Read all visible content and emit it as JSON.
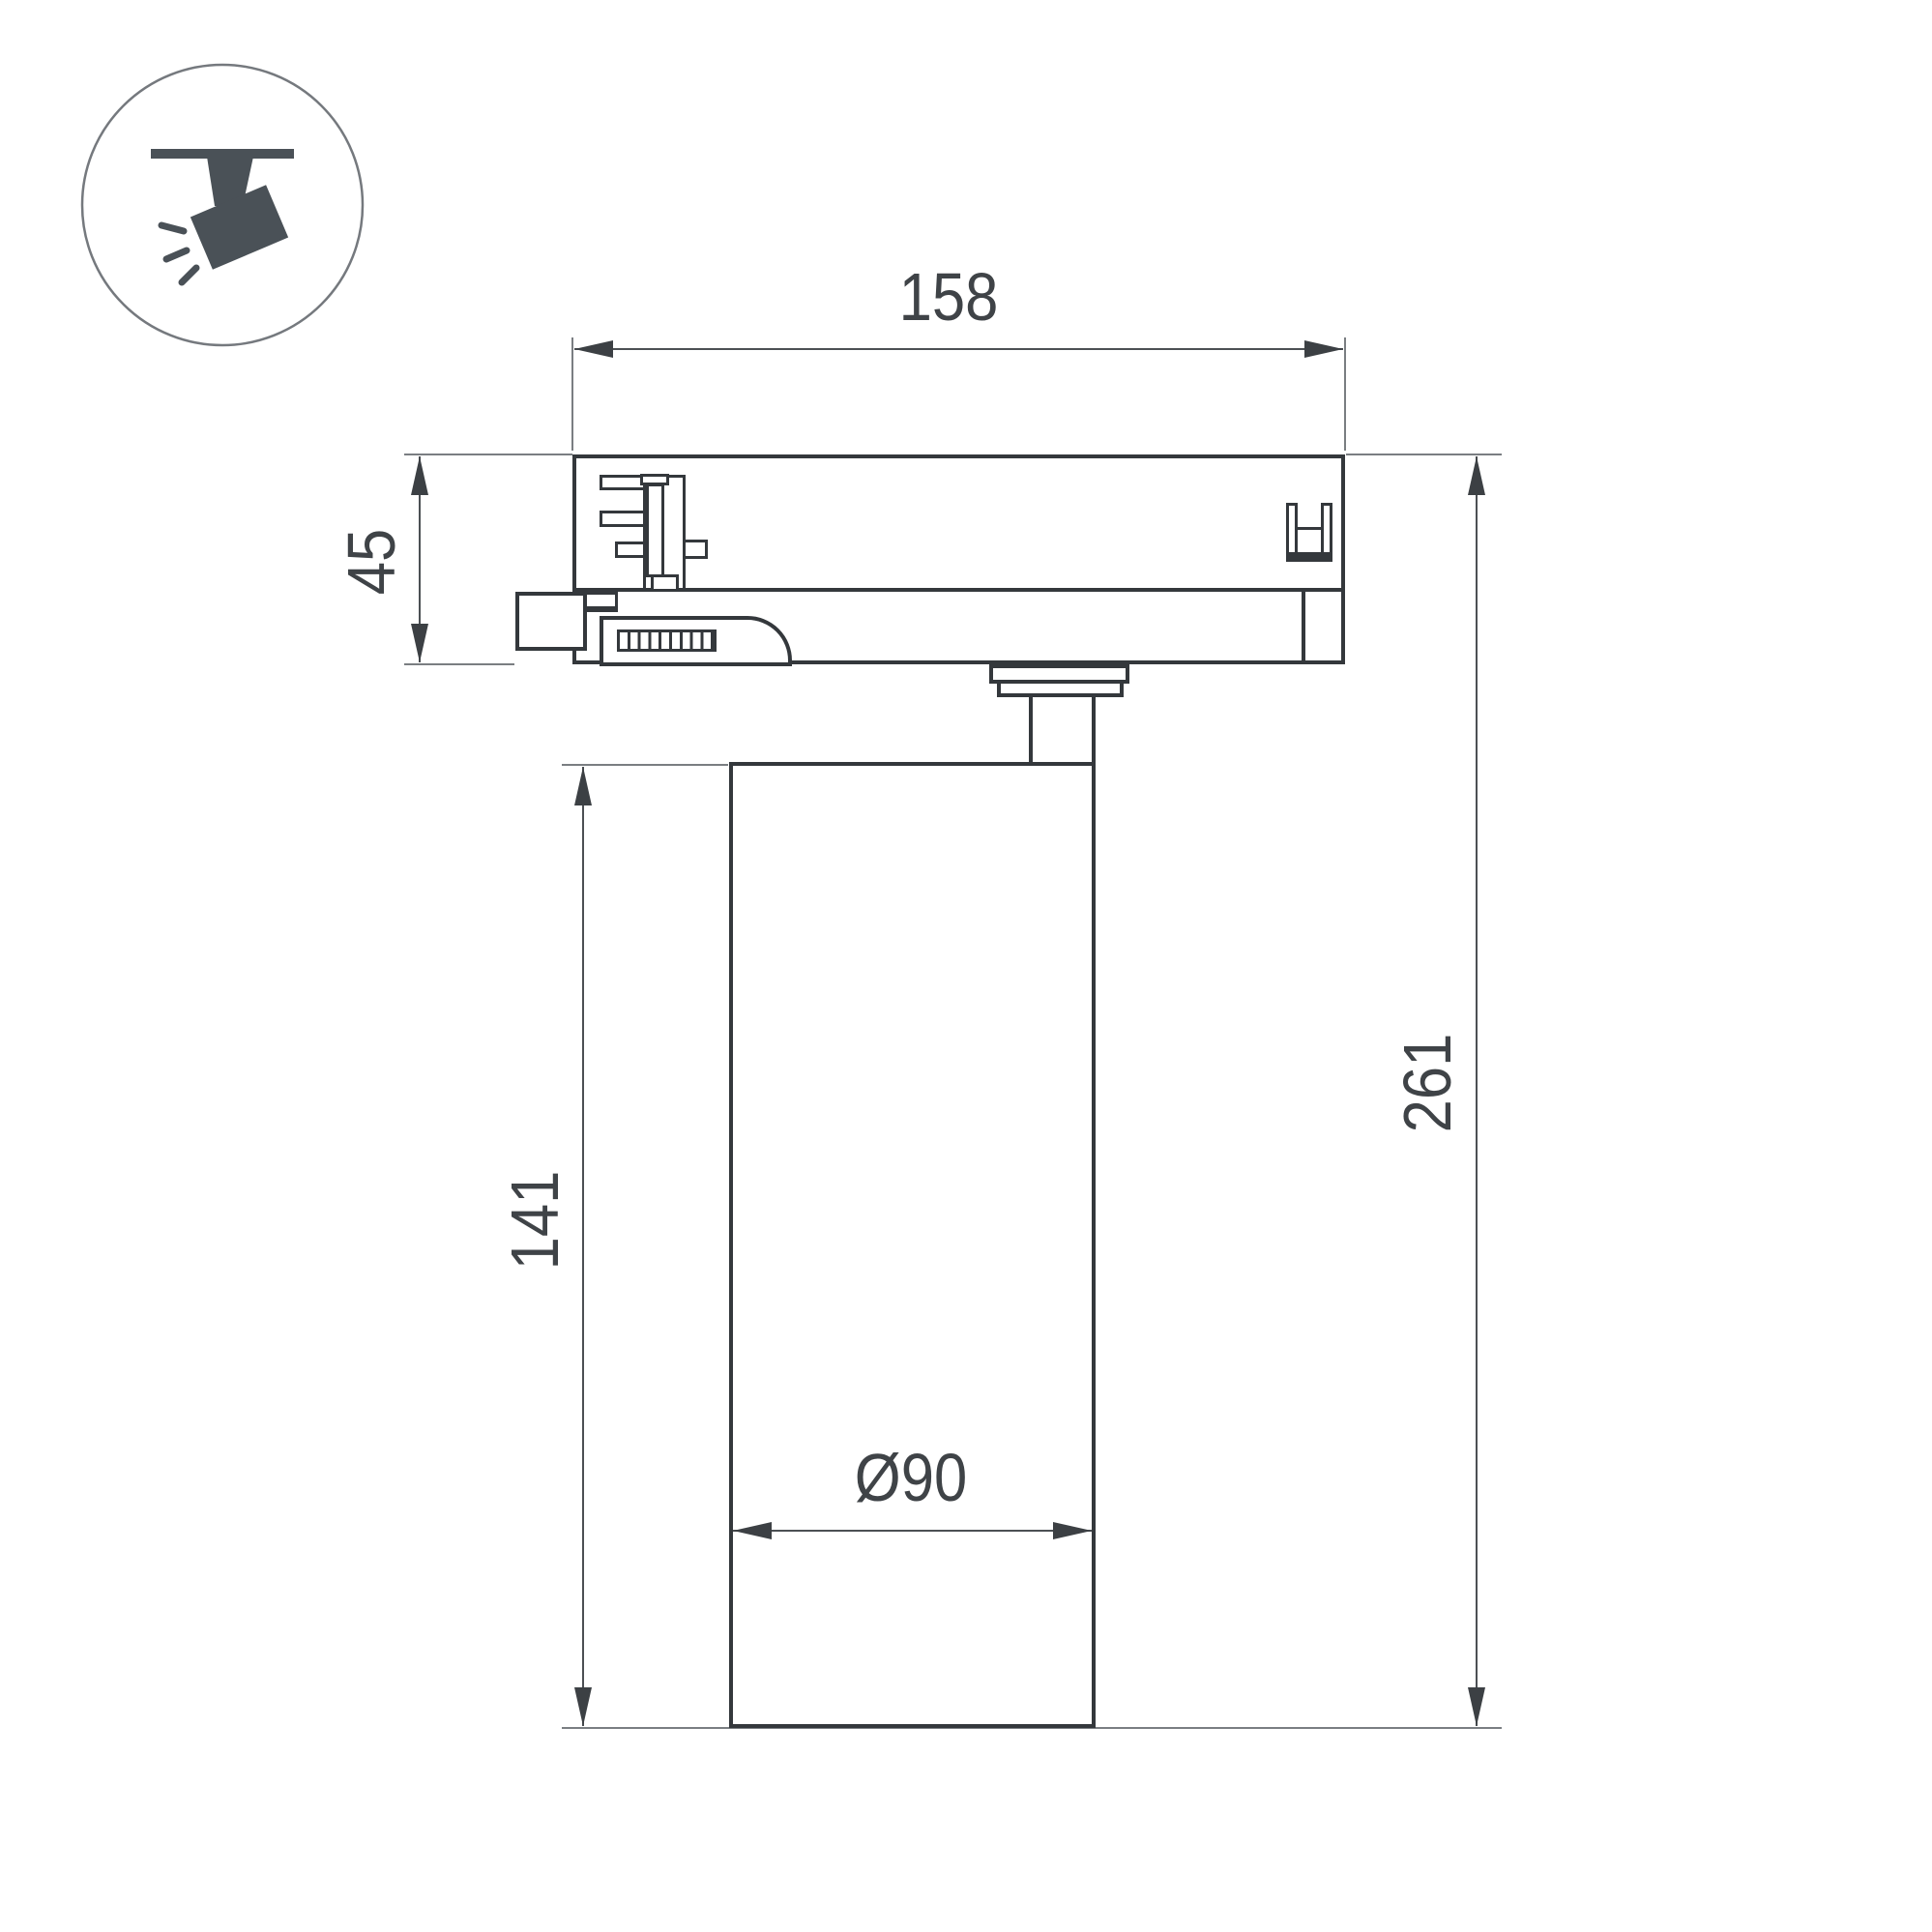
{
  "page": {
    "background": "#ffffff"
  },
  "colors": {
    "outline": "#34383c",
    "dimension_line": "#4c5054",
    "extension_line": "#7a7e82",
    "text": "#3f4347",
    "icon": "#4a5157"
  },
  "icon": {
    "label": "ceiling-track-spotlight-pictogram"
  },
  "dimensions": {
    "adapter_width": "158",
    "adapter_height": "45",
    "body_height": "141",
    "total_height": "261",
    "body_diameter": "Ø90"
  }
}
